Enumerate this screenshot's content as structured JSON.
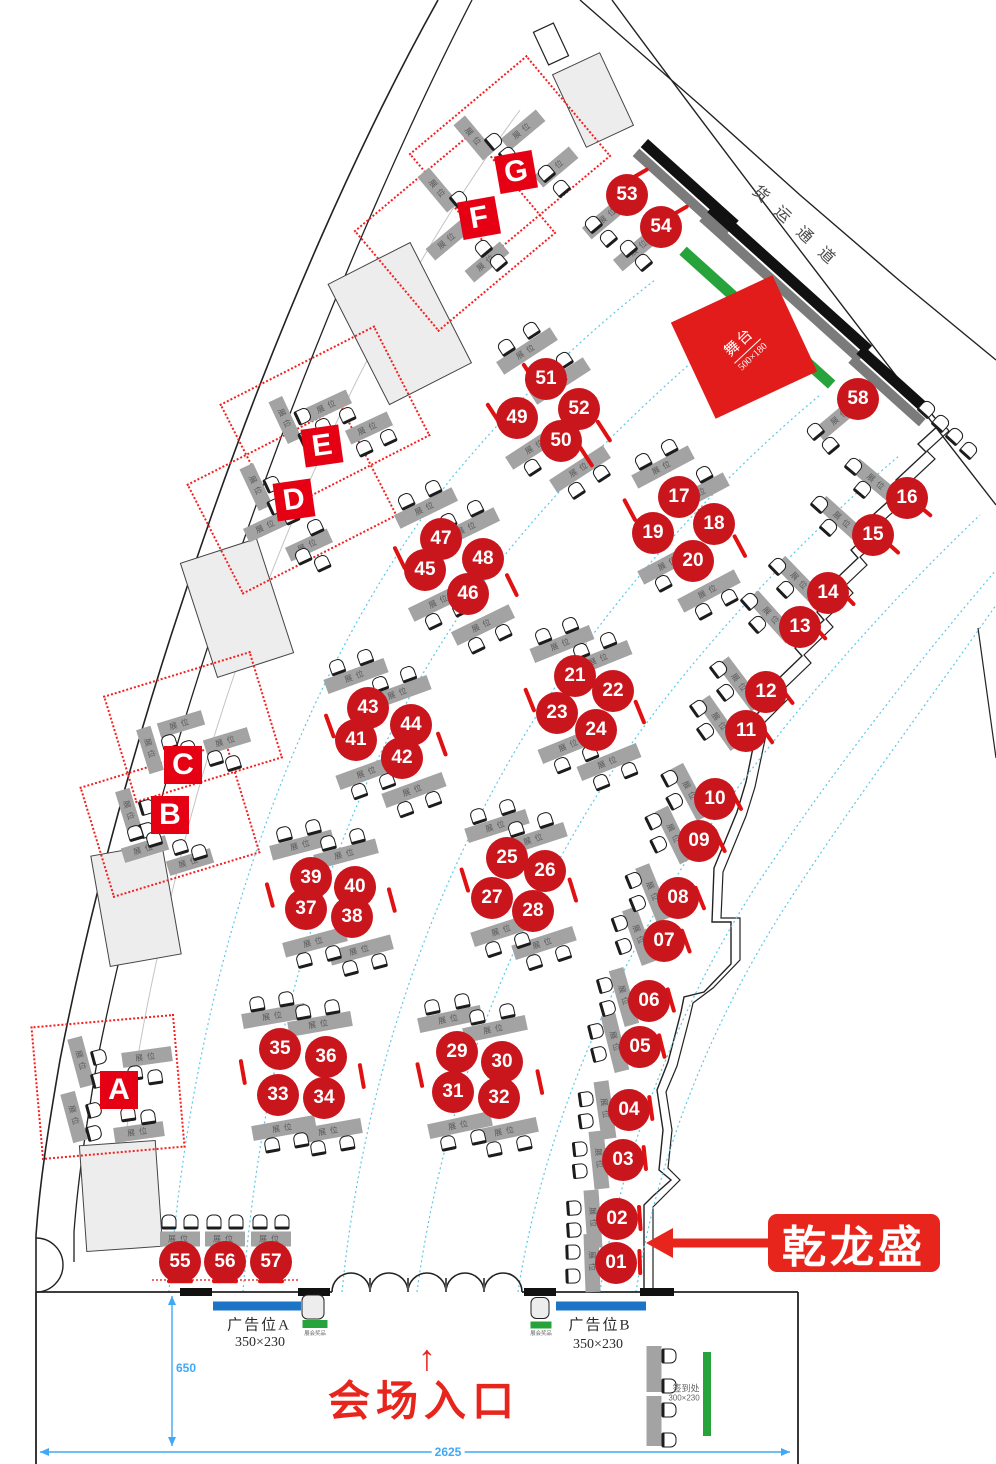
{
  "labels": {
    "freight": "货运通道",
    "stage_title": "舞台",
    "stage_size": "500×180",
    "entrance": "会场入口",
    "entrance_arrow": "↑",
    "company": "乾龙盛",
    "ad_a": "广告位A",
    "ad_a_size": "350×230",
    "ad_b": "广告位B",
    "ad_b_size": "350×230",
    "gift": "展会奖品",
    "signin": "签到处",
    "signin_size": "300×230",
    "booth": "展位",
    "dim_width": "2625",
    "dim_height": "650"
  },
  "colors": {
    "booth_red": "#c9151c",
    "letter_red": "#e60013",
    "accent_red": "#e8251d",
    "stage_red": "#e21b1b",
    "green": "#27a33b",
    "blue": "#1b74c5",
    "dim_blue": "#3fa9f5",
    "aisle_cyan": "#5bc8e8",
    "bar_gray": "#a3a3a3"
  },
  "booths": [
    {
      "n": "01",
      "x": 616,
      "y": 1263
    },
    {
      "n": "02",
      "x": 617,
      "y": 1219
    },
    {
      "n": "03",
      "x": 623,
      "y": 1160
    },
    {
      "n": "04",
      "x": 629,
      "y": 1110
    },
    {
      "n": "05",
      "x": 640,
      "y": 1047
    },
    {
      "n": "06",
      "x": 649,
      "y": 1001
    },
    {
      "n": "07",
      "x": 664,
      "y": 941
    },
    {
      "n": "08",
      "x": 678,
      "y": 898
    },
    {
      "n": "09",
      "x": 699,
      "y": 841
    },
    {
      "n": "10",
      "x": 715,
      "y": 799
    },
    {
      "n": "11",
      "x": 746,
      "y": 731
    },
    {
      "n": "12",
      "x": 766,
      "y": 692
    },
    {
      "n": "13",
      "x": 800,
      "y": 627
    },
    {
      "n": "14",
      "x": 828,
      "y": 593
    },
    {
      "n": "15",
      "x": 873,
      "y": 535
    },
    {
      "n": "16",
      "x": 907,
      "y": 498
    },
    {
      "n": "17",
      "x": 679,
      "y": 497
    },
    {
      "n": "18",
      "x": 714,
      "y": 524
    },
    {
      "n": "19",
      "x": 653,
      "y": 533
    },
    {
      "n": "20",
      "x": 693,
      "y": 561
    },
    {
      "n": "21",
      "x": 575,
      "y": 676
    },
    {
      "n": "22",
      "x": 613,
      "y": 691
    },
    {
      "n": "23",
      "x": 557,
      "y": 713
    },
    {
      "n": "24",
      "x": 596,
      "y": 730
    },
    {
      "n": "25",
      "x": 507,
      "y": 858
    },
    {
      "n": "26",
      "x": 545,
      "y": 871
    },
    {
      "n": "27",
      "x": 492,
      "y": 898
    },
    {
      "n": "28",
      "x": 533,
      "y": 911
    },
    {
      "n": "29",
      "x": 457,
      "y": 1052
    },
    {
      "n": "30",
      "x": 502,
      "y": 1062
    },
    {
      "n": "31",
      "x": 453,
      "y": 1092
    },
    {
      "n": "32",
      "x": 499,
      "y": 1098
    },
    {
      "n": "33",
      "x": 278,
      "y": 1095
    },
    {
      "n": "34",
      "x": 324,
      "y": 1098
    },
    {
      "n": "35",
      "x": 280,
      "y": 1049
    },
    {
      "n": "36",
      "x": 326,
      "y": 1057
    },
    {
      "n": "37",
      "x": 306,
      "y": 909
    },
    {
      "n": "38",
      "x": 352,
      "y": 917
    },
    {
      "n": "39",
      "x": 311,
      "y": 878
    },
    {
      "n": "40",
      "x": 355,
      "y": 887
    },
    {
      "n": "41",
      "x": 356,
      "y": 740
    },
    {
      "n": "42",
      "x": 402,
      "y": 758
    },
    {
      "n": "43",
      "x": 368,
      "y": 708
    },
    {
      "n": "44",
      "x": 411,
      "y": 725
    },
    {
      "n": "45",
      "x": 425,
      "y": 570
    },
    {
      "n": "46",
      "x": 468,
      "y": 594
    },
    {
      "n": "47",
      "x": 441,
      "y": 539
    },
    {
      "n": "48",
      "x": 483,
      "y": 559
    },
    {
      "n": "49",
      "x": 517,
      "y": 418
    },
    {
      "n": "50",
      "x": 561,
      "y": 441
    },
    {
      "n": "51",
      "x": 546,
      "y": 379
    },
    {
      "n": "52",
      "x": 579,
      "y": 409
    },
    {
      "n": "53",
      "x": 627,
      "y": 195
    },
    {
      "n": "54",
      "x": 661,
      "y": 227
    },
    {
      "n": "55",
      "x": 180,
      "y": 1262
    },
    {
      "n": "56",
      "x": 225,
      "y": 1262
    },
    {
      "n": "57",
      "x": 271,
      "y": 1262
    },
    {
      "n": "58",
      "x": 858,
      "y": 399
    }
  ],
  "zones": [
    {
      "letter": "G",
      "lx": 516,
      "ly": 172,
      "lr": -10,
      "rx": 510,
      "ry": 155,
      "rw": 150,
      "rh": 128,
      "rr": -40
    },
    {
      "letter": "F",
      "lx": 479,
      "ly": 218,
      "lr": -10,
      "rx": 455,
      "ry": 232,
      "rw": 150,
      "rh": 128,
      "rr": -40
    },
    {
      "letter": "E",
      "lx": 322,
      "ly": 446,
      "lr": -8,
      "rx": 325,
      "ry": 420,
      "rw": 170,
      "rh": 120,
      "rr": -27
    },
    {
      "letter": "D",
      "lx": 294,
      "ly": 500,
      "lr": -8,
      "rx": 292,
      "ry": 500,
      "rw": 170,
      "rh": 120,
      "rr": -27
    },
    {
      "letter": "C",
      "lx": 183,
      "ly": 765,
      "lr": 0,
      "rx": 193,
      "ry": 727,
      "rw": 150,
      "rh": 108,
      "rr": -17
    },
    {
      "letter": "B",
      "lx": 170,
      "ly": 815,
      "lr": 0,
      "rx": 170,
      "ry": 820,
      "rw": 150,
      "rh": 112,
      "rr": -17
    },
    {
      "letter": "A",
      "lx": 119,
      "ly": 1090,
      "lr": 0,
      "rx": 108,
      "ry": 1087,
      "rw": 140,
      "rh": 130,
      "rr": -5
    }
  ],
  "bars": [
    [
      527,
      351,
      -33
    ],
    [
      560,
      381,
      -33
    ],
    [
      536,
      446,
      -33
    ],
    [
      580,
      469,
      -33
    ],
    [
      663,
      467,
      -28
    ],
    [
      698,
      494,
      -28
    ],
    [
      669,
      563,
      -28
    ],
    [
      709,
      591,
      -28
    ],
    [
      562,
      644,
      -22
    ],
    [
      600,
      659,
      -22
    ],
    [
      570,
      745,
      -22
    ],
    [
      609,
      762,
      -22
    ],
    [
      497,
      826,
      -18
    ],
    [
      535,
      839,
      -18
    ],
    [
      503,
      930,
      -18
    ],
    [
      544,
      943,
      -18
    ],
    [
      450,
      1019,
      -12
    ],
    [
      495,
      1029,
      -12
    ],
    [
      460,
      1125,
      -12
    ],
    [
      506,
      1131,
      -12
    ],
    [
      274,
      1016,
      -10
    ],
    [
      320,
      1024,
      -10
    ],
    [
      284,
      1128,
      -10
    ],
    [
      330,
      1131,
      -10
    ],
    [
      302,
      845,
      -15
    ],
    [
      346,
      854,
      -15
    ],
    [
      315,
      942,
      -15
    ],
    [
      361,
      950,
      -15
    ],
    [
      356,
      676,
      -20
    ],
    [
      399,
      693,
      -20
    ],
    [
      368,
      772,
      -20
    ],
    [
      414,
      790,
      -20
    ],
    [
      426,
      508,
      -26
    ],
    [
      468,
      528,
      -26
    ],
    [
      440,
      601,
      -26
    ],
    [
      483,
      625,
      -26
    ],
    [
      592,
      1263,
      88,
      58
    ],
    [
      593,
      1219,
      86,
      58
    ],
    [
      599,
      1160,
      84,
      58
    ],
    [
      605,
      1110,
      82,
      58
    ],
    [
      615,
      1043,
      76,
      58
    ],
    [
      624,
      997,
      74,
      58
    ],
    [
      639,
      936,
      70,
      58
    ],
    [
      653,
      893,
      68,
      58
    ],
    [
      674,
      835,
      64,
      58
    ],
    [
      690,
      792,
      62,
      58
    ],
    [
      720,
      723,
      55,
      58
    ],
    [
      740,
      684,
      53,
      58
    ],
    [
      772,
      617,
      48,
      58
    ],
    [
      800,
      582,
      46,
      58
    ],
    [
      843,
      521,
      42,
      58
    ],
    [
      877,
      483,
      40,
      58
    ],
    [
      609,
      215,
      -40,
      58
    ],
    [
      640,
      247,
      -40,
      58
    ],
    [
      841,
      416,
      -40,
      58
    ],
    [
      180,
      1239,
      0,
      40
    ],
    [
      225,
      1239,
      0,
      40
    ],
    [
      271,
      1239,
      0,
      40
    ],
    [
      81,
      1062,
      75,
      50
    ],
    [
      74,
      1117,
      75,
      50
    ],
    [
      147,
      1057,
      -8,
      50
    ],
    [
      139,
      1132,
      -8,
      50
    ],
    [
      129,
      812,
      73,
      46
    ],
    [
      145,
      849,
      -17,
      46
    ],
    [
      190,
      862,
      -17,
      46
    ],
    [
      181,
      724,
      -17,
      46
    ],
    [
      227,
      741,
      -17,
      46
    ],
    [
      150,
      750,
      73,
      46
    ],
    [
      256,
      487,
      65,
      46
    ],
    [
      267,
      526,
      -25,
      46
    ],
    [
      309,
      545,
      -25,
      46
    ],
    [
      328,
      406,
      -25,
      46
    ],
    [
      369,
      428,
      -25,
      46
    ],
    [
      285,
      420,
      65,
      46
    ],
    [
      438,
      190,
      50,
      46
    ],
    [
      448,
      240,
      -40,
      46
    ],
    [
      487,
      262,
      -40,
      46
    ],
    [
      474,
      138,
      50,
      46
    ],
    [
      523,
      130,
      -40,
      46
    ],
    [
      556,
      167,
      -40,
      46
    ],
    [
      654,
      1369,
      90,
      46,
      0
    ],
    [
      654,
      1421,
      90,
      50,
      0
    ]
  ],
  "chairs": [
    [
      531,
      330,
      -33
    ],
    [
      506,
      347,
      -33
    ],
    [
      564,
      360,
      -33
    ],
    [
      539,
      377,
      -33
    ],
    [
      557,
      450,
      -33
    ],
    [
      532,
      467,
      -33
    ],
    [
      601,
      473,
      -33
    ],
    [
      576,
      490,
      -33
    ],
    [
      669,
      447,
      -28
    ],
    [
      643,
      461,
      -28
    ],
    [
      704,
      474,
      -28
    ],
    [
      678,
      488,
      -28
    ],
    [
      689,
      569,
      -28
    ],
    [
      663,
      583,
      -28
    ],
    [
      729,
      597,
      -28
    ],
    [
      703,
      611,
      -28
    ],
    [
      570,
      625,
      -22
    ],
    [
      543,
      636,
      -22
    ],
    [
      608,
      640,
      -22
    ],
    [
      581,
      651,
      -22
    ],
    [
      590,
      753,
      -22
    ],
    [
      562,
      765,
      -22
    ],
    [
      629,
      770,
      -22
    ],
    [
      601,
      782,
      -22
    ],
    [
      507,
      807,
      -18
    ],
    [
      478,
      816,
      -18
    ],
    [
      545,
      820,
      -18
    ],
    [
      516,
      829,
      -18
    ],
    [
      522,
      940,
      -18
    ],
    [
      493,
      949,
      -18
    ],
    [
      563,
      953,
      -18
    ],
    [
      534,
      962,
      -18
    ],
    [
      462,
      1001,
      -12
    ],
    [
      432,
      1007,
      -12
    ],
    [
      507,
      1011,
      -12
    ],
    [
      477,
      1017,
      -12
    ],
    [
      478,
      1137,
      -12
    ],
    [
      448,
      1143,
      -12
    ],
    [
      524,
      1143,
      -12
    ],
    [
      494,
      1149,
      -12
    ],
    [
      286,
      999,
      -10
    ],
    [
      257,
      1004,
      -10
    ],
    [
      332,
      1007,
      -10
    ],
    [
      303,
      1012,
      -10
    ],
    [
      301,
      1140,
      -10
    ],
    [
      272,
      1145,
      -10
    ],
    [
      347,
      1143,
      -10
    ],
    [
      318,
      1148,
      -10
    ],
    [
      313,
      827,
      -15
    ],
    [
      284,
      834,
      -15
    ],
    [
      357,
      836,
      -15
    ],
    [
      328,
      843,
      -15
    ],
    [
      333,
      953,
      -15
    ],
    [
      304,
      960,
      -15
    ],
    [
      379,
      961,
      -15
    ],
    [
      350,
      968,
      -15
    ],
    [
      365,
      657,
      -20
    ],
    [
      337,
      667,
      -20
    ],
    [
      408,
      674,
      -20
    ],
    [
      380,
      684,
      -20
    ],
    [
      387,
      781,
      -20
    ],
    [
      359,
      791,
      -20
    ],
    [
      433,
      799,
      -20
    ],
    [
      405,
      809,
      -20
    ],
    [
      433,
      488,
      -26
    ],
    [
      406,
      501,
      -26
    ],
    [
      475,
      508,
      -26
    ],
    [
      448,
      521,
      -26
    ],
    [
      460,
      608,
      -26
    ],
    [
      433,
      621,
      -26
    ],
    [
      503,
      632,
      -26
    ],
    [
      476,
      645,
      -26
    ],
    [
      573,
      1252,
      88
    ],
    [
      573,
      1276,
      88
    ],
    [
      574,
      1208,
      86
    ],
    [
      574,
      1230,
      86
    ],
    [
      580,
      1149,
      84
    ],
    [
      580,
      1171,
      84
    ],
    [
      586,
      1099,
      82
    ],
    [
      586,
      1121,
      82
    ],
    [
      596,
      1031,
      76
    ],
    [
      599,
      1054,
      76
    ],
    [
      605,
      985,
      74
    ],
    [
      608,
      1008,
      74
    ],
    [
      620,
      923,
      70
    ],
    [
      624,
      946,
      70
    ],
    [
      634,
      880,
      68
    ],
    [
      638,
      903,
      68
    ],
    [
      654,
      821,
      64
    ],
    [
      659,
      844,
      64
    ],
    [
      670,
      778,
      62
    ],
    [
      675,
      801,
      62
    ],
    [
      699,
      708,
      55
    ],
    [
      706,
      731,
      55
    ],
    [
      719,
      669,
      53
    ],
    [
      726,
      692,
      53
    ],
    [
      750,
      601,
      48
    ],
    [
      758,
      624,
      48
    ],
    [
      778,
      566,
      46
    ],
    [
      786,
      589,
      46
    ],
    [
      820,
      504,
      42
    ],
    [
      829,
      527,
      42
    ],
    [
      854,
      466,
      40
    ],
    [
      863,
      489,
      40
    ],
    [
      593,
      224,
      -40
    ],
    [
      608,
      238,
      -40
    ],
    [
      628,
      248,
      -40
    ],
    [
      643,
      262,
      -40
    ],
    [
      815,
      431,
      -40
    ],
    [
      830,
      445,
      -40
    ],
    [
      169,
      1222,
      0
    ],
    [
      191,
      1222,
      0
    ],
    [
      214,
      1222,
      0
    ],
    [
      236,
      1222,
      0
    ],
    [
      260,
      1222,
      0
    ],
    [
      282,
      1222,
      0
    ],
    [
      99,
      1057,
      75
    ],
    [
      99,
      1080,
      75
    ],
    [
      94,
      1110,
      75
    ],
    [
      94,
      1133,
      75
    ],
    [
      135,
      1073,
      -8
    ],
    [
      155,
      1077,
      -8
    ],
    [
      128,
      1114,
      -8
    ],
    [
      148,
      1117,
      -8
    ],
    [
      147,
      807,
      73
    ],
    [
      147,
      830,
      73
    ],
    [
      135,
      833,
      -17
    ],
    [
      154,
      839,
      -17
    ],
    [
      180,
      847,
      -17
    ],
    [
      199,
      852,
      -17
    ],
    [
      169,
      742,
      -17
    ],
    [
      188,
      748,
      -17
    ],
    [
      215,
      758,
      -17
    ],
    [
      233,
      763,
      -17
    ],
    [
      272,
      484,
      65
    ],
    [
      276,
      506,
      65
    ],
    [
      291,
      516,
      -25
    ],
    [
      315,
      527,
      -25
    ],
    [
      303,
      556,
      -25
    ],
    [
      322,
      563,
      -25
    ],
    [
      347,
      415,
      -25
    ],
    [
      323,
      426,
      -25
    ],
    [
      388,
      437,
      -25
    ],
    [
      364,
      448,
      -25
    ],
    [
      303,
      416,
      65
    ],
    [
      307,
      438,
      65
    ],
    [
      459,
      199,
      50
    ],
    [
      473,
      213,
      50
    ],
    [
      483,
      248,
      -40
    ],
    [
      498,
      262,
      -40
    ],
    [
      494,
      141,
      50
    ],
    [
      508,
      155,
      50
    ],
    [
      546,
      173,
      -40
    ],
    [
      561,
      188,
      -40
    ],
    [
      927,
      409,
      42
    ],
    [
      941,
      423,
      42
    ],
    [
      955,
      436,
      42
    ],
    [
      969,
      450,
      42
    ],
    [
      669,
      1356,
      90
    ],
    [
      669,
      1386,
      90
    ],
    [
      669,
      1410,
      90
    ],
    [
      669,
      1440,
      90
    ]
  ],
  "ticks": [
    [
      494,
      414,
      57
    ],
    [
      604,
      431,
      57
    ],
    [
      530,
      374,
      57
    ],
    [
      586,
      456,
      57
    ],
    [
      630,
      510,
      62
    ],
    [
      740,
      546,
      62
    ],
    [
      530,
      700,
      68
    ],
    [
      640,
      712,
      68
    ],
    [
      465,
      880,
      73
    ],
    [
      573,
      890,
      73
    ],
    [
      420,
      1075,
      78
    ],
    [
      540,
      1082,
      78
    ],
    [
      243,
      1072,
      80
    ],
    [
      362,
      1076,
      80
    ],
    [
      270,
      895,
      75
    ],
    [
      392,
      900,
      75
    ],
    [
      330,
      726,
      70
    ],
    [
      442,
      744,
      70
    ],
    [
      400,
      558,
      64
    ],
    [
      512,
      585,
      64
    ],
    [
      637,
      175,
      -30
    ],
    [
      677,
      212,
      -30
    ],
    [
      180,
      1281,
      0
    ],
    [
      225,
      1281,
      0
    ],
    [
      271,
      1281,
      0
    ],
    [
      640,
      1262,
      88
    ],
    [
      640,
      1218,
      86
    ],
    [
      645,
      1158,
      84
    ],
    [
      651,
      1108,
      82
    ],
    [
      662,
      1046,
      76
    ],
    [
      671,
      1000,
      74
    ],
    [
      686,
      941,
      70
    ],
    [
      700,
      898,
      68
    ],
    [
      720,
      841,
      64
    ],
    [
      736,
      799,
      62
    ],
    [
      766,
      733,
      55
    ],
    [
      786,
      694,
      53
    ],
    [
      818,
      630,
      48
    ],
    [
      846,
      596,
      46
    ],
    [
      890,
      545,
      42
    ],
    [
      922,
      508,
      40
    ]
  ]
}
